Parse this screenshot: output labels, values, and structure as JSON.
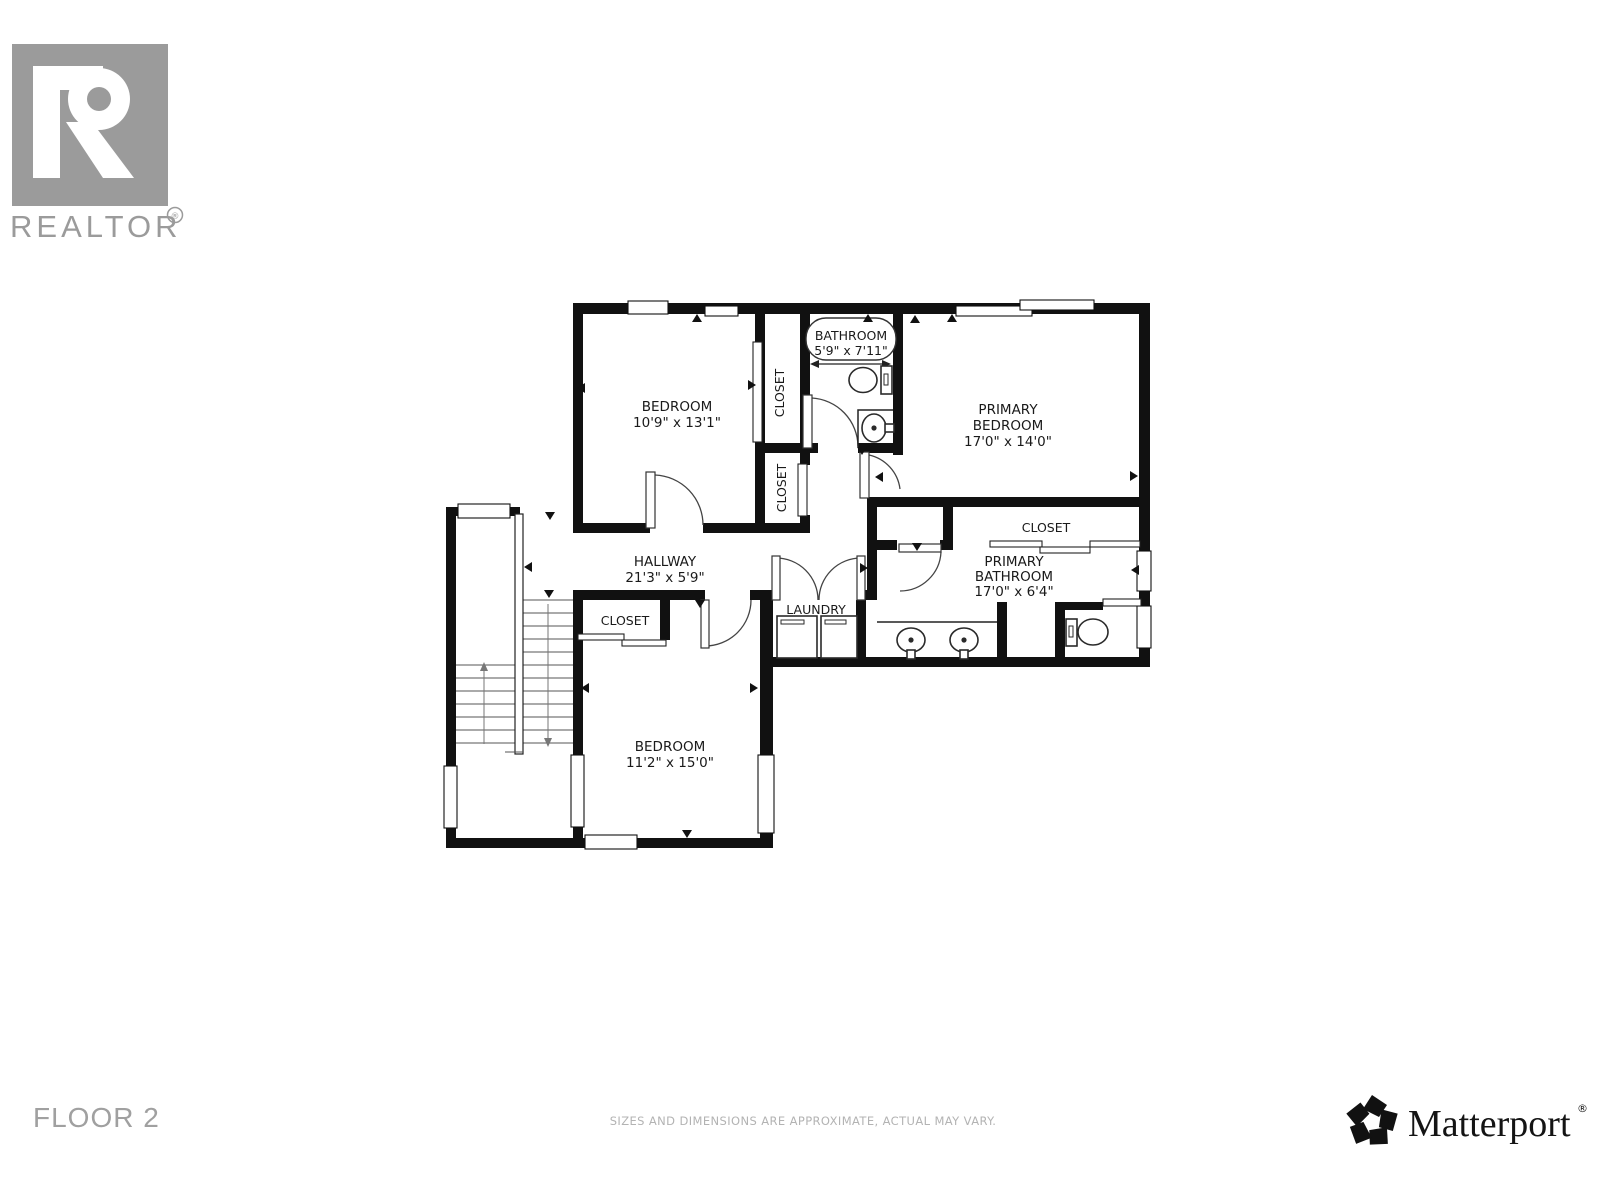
{
  "branding": {
    "realtor_wordmark": "REALTOR",
    "registered": "®"
  },
  "footer": {
    "floor_label": "FLOOR 2",
    "disclaimer": "SIZES AND DIMENSIONS ARE APPROXIMATE, ACTUAL MAY VARY.",
    "matterport_wordmark": "Matterport",
    "registered": "®"
  },
  "colors": {
    "wall": "#111111",
    "logo_gray": "#9b9b9b",
    "floor_label_gray": "#a0a0a0",
    "disclaimer_gray": "#b3b3b3"
  },
  "rooms": {
    "bedroom_upper": {
      "name": "BEDROOM",
      "dims": "10'9\" x 13'1\""
    },
    "bathroom": {
      "name": "BATHROOM",
      "dims": "5'9\" x 7'11\""
    },
    "primary_bedroom": {
      "name_line1": "PRIMARY",
      "name_line2": "BEDROOM",
      "dims": "17'0\" x 14'0\""
    },
    "hallway": {
      "name": "HALLWAY",
      "dims": "21'3\" x 5'9\""
    },
    "laundry": {
      "name": "LAUNDRY"
    },
    "primary_bathroom": {
      "name_line1": "PRIMARY",
      "name_line2": "BATHROOM",
      "dims": "17'0\" x 6'4\""
    },
    "bedroom_lower": {
      "name": "BEDROOM",
      "dims": "11'2\" x 15'0\""
    },
    "closet_upper": {
      "name": "CLOSET"
    },
    "closet_lower": {
      "name": "CLOSET"
    },
    "closet_primary": {
      "name": "CLOSET"
    },
    "closet_hall": {
      "name": "CLOSET"
    }
  }
}
